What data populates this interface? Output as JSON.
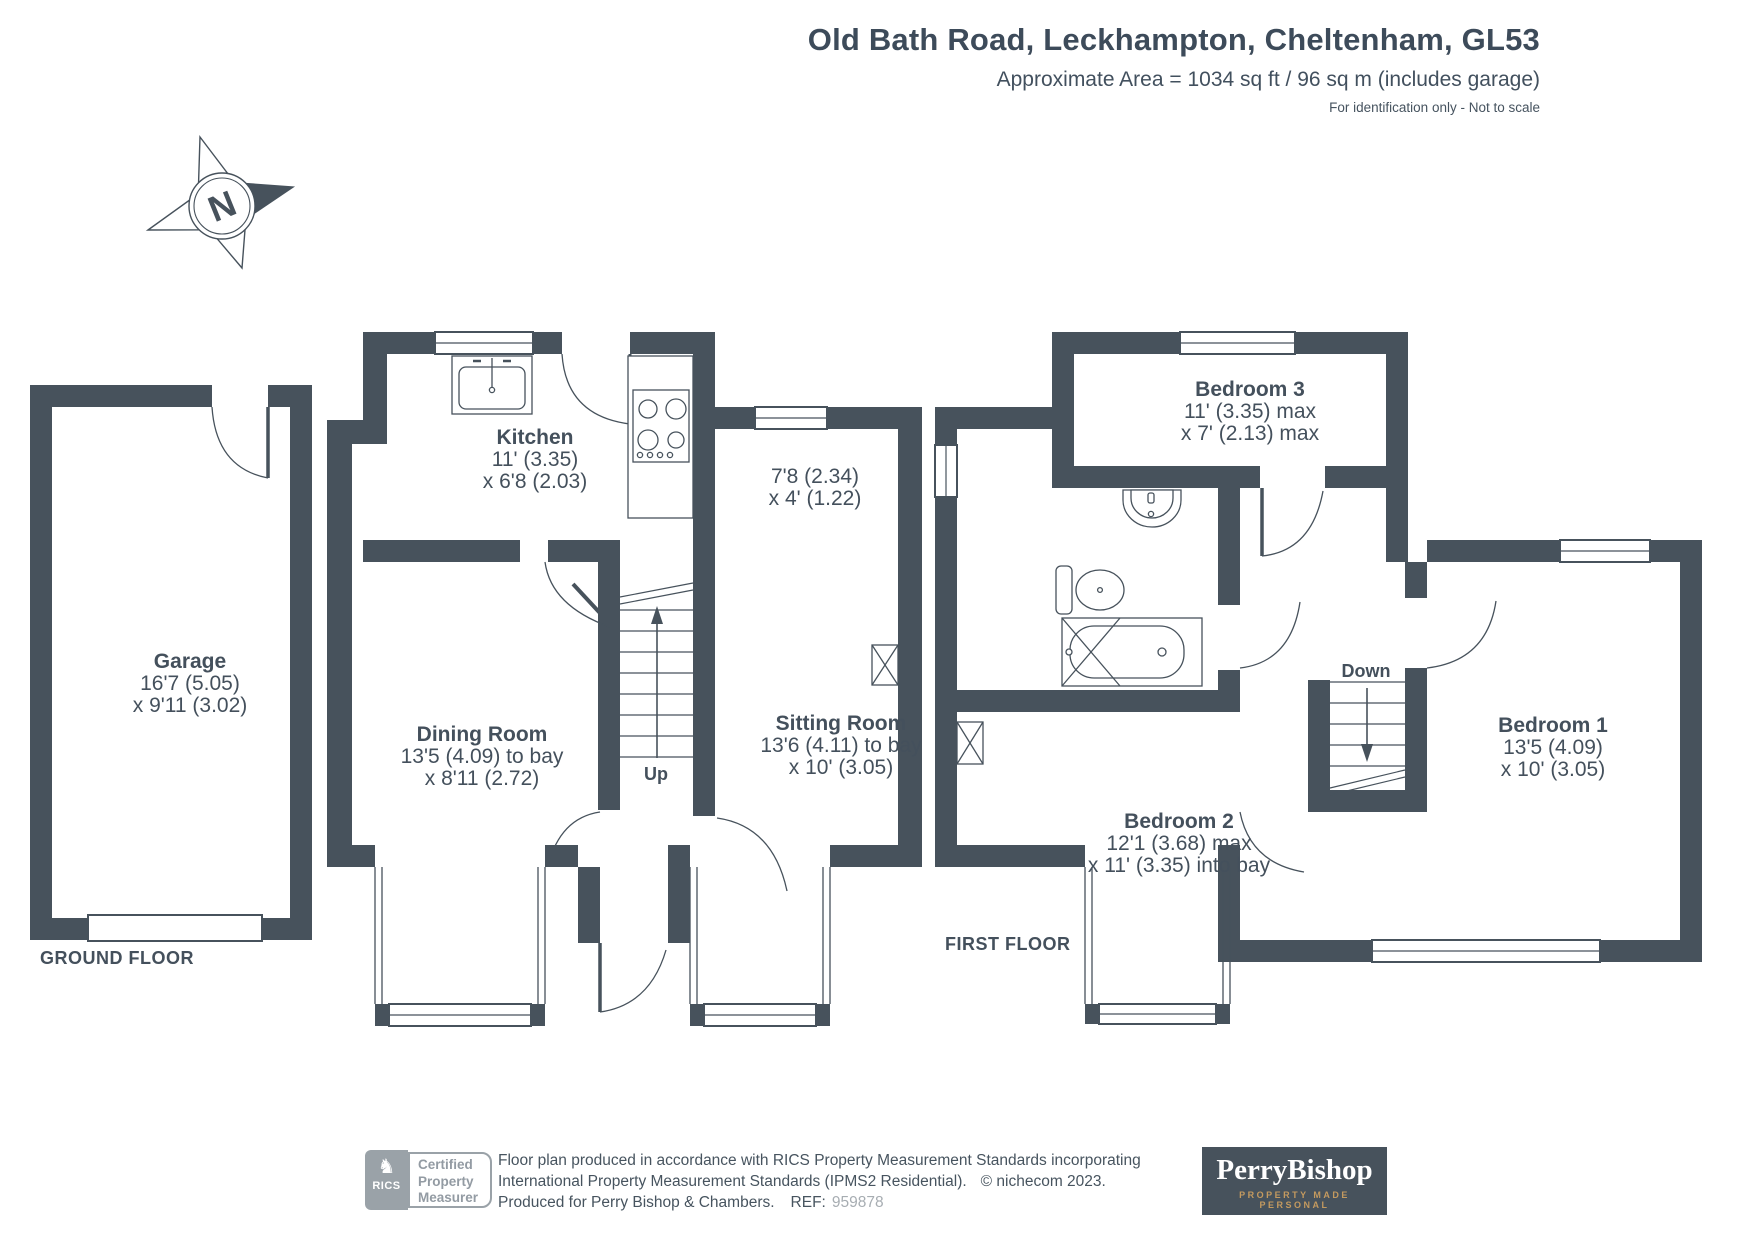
{
  "header": {
    "title": "Old Bath Road, Leckhampton, Cheltenham, GL53",
    "subtitle": "Approximate Area = 1034 sq ft / 96 sq m (includes garage)",
    "note": "For identification only - Not to scale"
  },
  "compass": {
    "label": "N"
  },
  "floors": {
    "ground": {
      "label": "GROUND FLOOR"
    },
    "first": {
      "label": "FIRST FLOOR"
    }
  },
  "rooms": {
    "garage": {
      "name": "Garage",
      "dim1": "16'7 (5.05)",
      "dim2": "x 9'11 (3.02)"
    },
    "kitchen": {
      "name": "Kitchen",
      "dim1": "11' (3.35)",
      "dim2": "x 6'8 (2.03)"
    },
    "hall": {
      "dim1": "7'8 (2.34)",
      "dim2": "x 4' (1.22)"
    },
    "dining": {
      "name": "Dining Room",
      "dim1": "13'5 (4.09) to bay",
      "dim2": "x 8'11 (2.72)"
    },
    "sitting": {
      "name": "Sitting Room",
      "dim1": "13'6 (4.11) to bay",
      "dim2": "x 10' (3.05)"
    },
    "bedroom1": {
      "name": "Bedroom 1",
      "dim1": "13'5 (4.09)",
      "dim2": "x 10' (3.05)"
    },
    "bedroom2": {
      "name": "Bedroom 2",
      "dim1": "12'1 (3.68) max",
      "dim2": "x 11' (3.35) into bay"
    },
    "bedroom3": {
      "name": "Bedroom 3",
      "dim1": "11' (3.35) max",
      "dim2": "x 7' (2.13) max"
    }
  },
  "stairs": {
    "up": "Up",
    "down": "Down"
  },
  "footer": {
    "rics": {
      "brand": "RICS",
      "line1": "Certified",
      "line2": "Property",
      "line3": "Measurer"
    },
    "disclaimer_line1": "Floor plan produced in accordance with RICS Property Measurement Standards incorporating",
    "disclaimer_line2": "International Property Measurement Standards (IPMS2 Residential).",
    "copyright": "© nichecom 2023.",
    "produced": "Produced for Perry Bishop & Chambers.",
    "ref_label": "REF:",
    "ref_value": "959878",
    "agency": {
      "name": "PerryBishop",
      "tagline": "PROPERTY MADE PERSONAL"
    }
  },
  "colors": {
    "wall": "#47525c",
    "text": "#44505c",
    "muted": "#9aa2a8",
    "gold": "#c49a5f"
  }
}
